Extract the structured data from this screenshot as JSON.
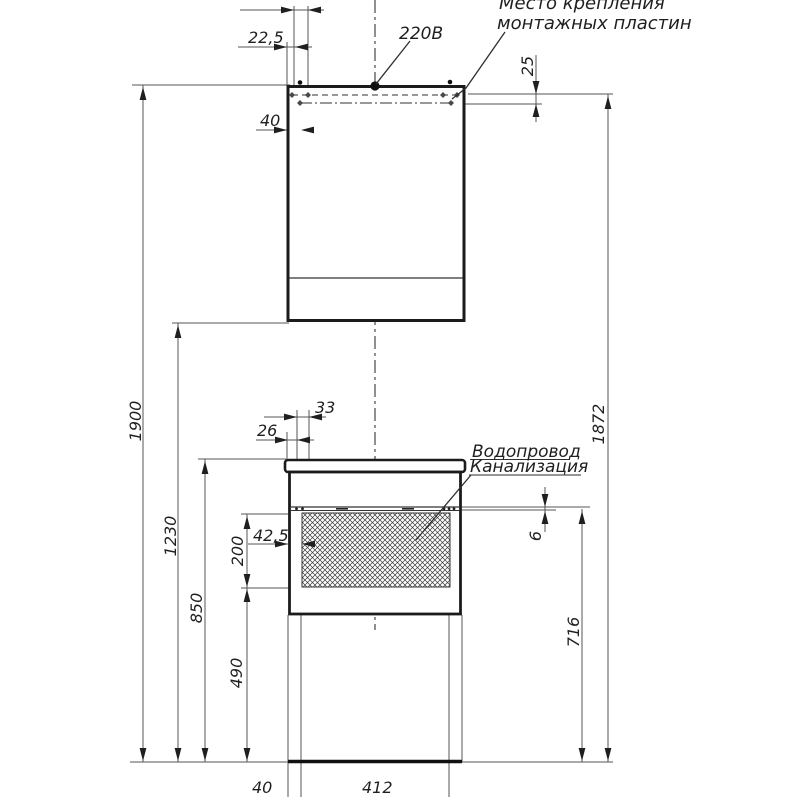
{
  "labels": {
    "mounting_note_line1": "Место крепления",
    "mounting_note_line2": "монтажных пластин",
    "power": "220В",
    "water_supply": "Водопровод",
    "sewerage": "Канализация"
  },
  "dimensions": {
    "top_width_small": "22,5",
    "plate_offset_top": "40",
    "plate_drop": "25",
    "total_height": "1900",
    "plate_height": "1872",
    "cabinet_bottom_height": "1230",
    "countertop_height": "850",
    "opening_bottom_height": "490",
    "opening_height": "200",
    "rail_offset_b": "33",
    "rail_offset_a": "26",
    "opening_side_offset": "42,5",
    "shelf_gap": "6",
    "shelf_height": "716",
    "base_offset": "40",
    "base_width": "412"
  },
  "colors": {
    "background": "#ffffff",
    "object_line": "#1b1b1b",
    "thin_line": "#565656",
    "text": "#1f1f1f"
  }
}
